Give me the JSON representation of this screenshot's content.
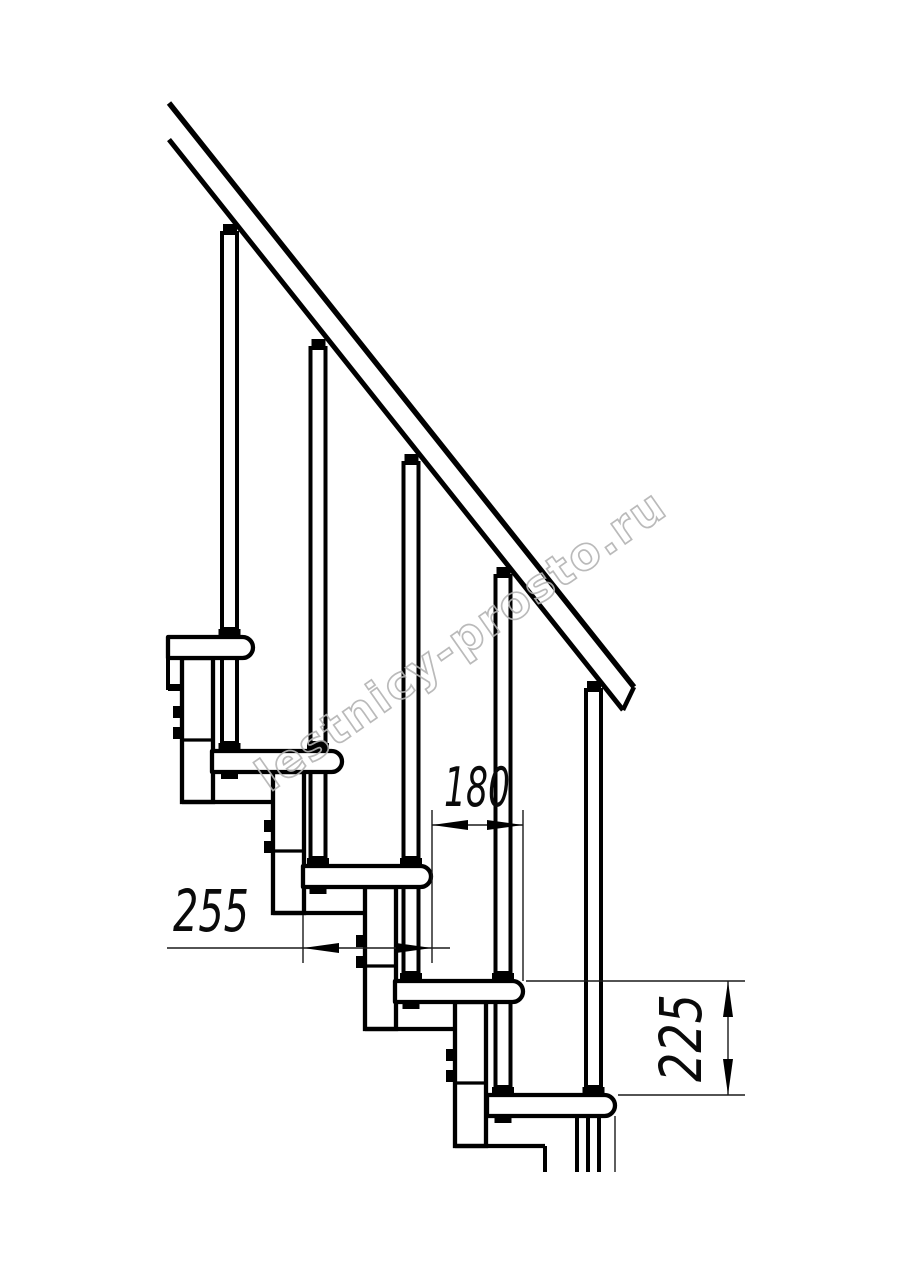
{
  "figure": {
    "background": "#ffffff",
    "line_color": "#000000",
    "dimensions": {
      "horizontal_upper": "180",
      "horizontal_lower": "255",
      "vertical_right": "225"
    },
    "watermark": {
      "text": "lestnicy-prosto.ru",
      "color": "#b3b3b3"
    }
  }
}
